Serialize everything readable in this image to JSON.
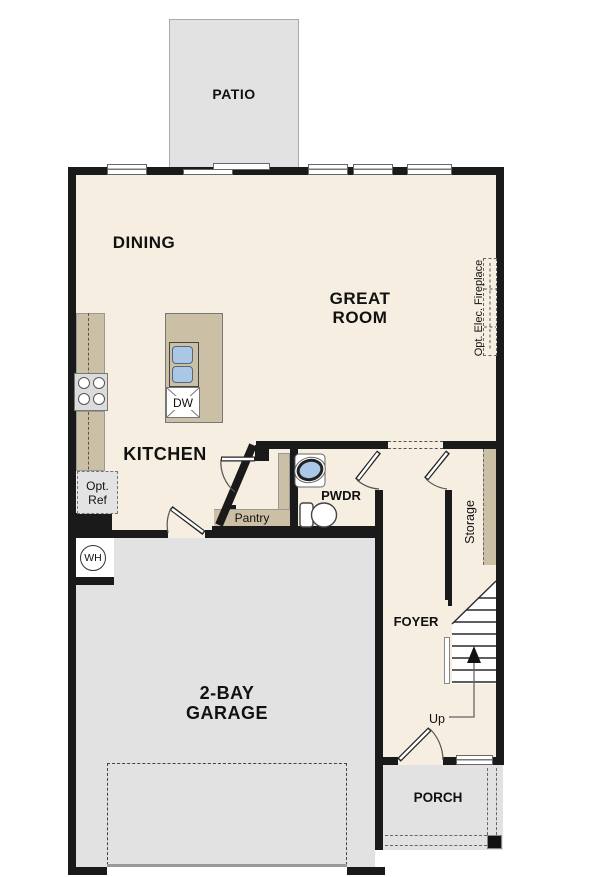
{
  "floorplan": {
    "rooms": {
      "patio": "PATIO",
      "dining": "DINING",
      "great_line1": "GREAT",
      "great_line2": "ROOM",
      "kitchen": "KITCHEN",
      "powder": "PWDR",
      "foyer": "FOYER",
      "garage_line1": "2-BAY",
      "garage_line2": "GARAGE",
      "porch": "PORCH"
    },
    "features": {
      "pantry": "Pantry",
      "storage": "Storage",
      "opt_fireplace": "Opt. Elec. Fireplace",
      "opt_ref_line1": "Opt.",
      "opt_ref_line2": "Ref",
      "dishwasher": "DW",
      "water_heater": "WH",
      "stairs_up": "Up"
    },
    "colors": {
      "floor": "#f5eee1",
      "concrete": "#e3e2e2",
      "cabinet": "#cbbfa5",
      "wall": "#1a1a1a",
      "sink": "#aac8e6"
    }
  }
}
